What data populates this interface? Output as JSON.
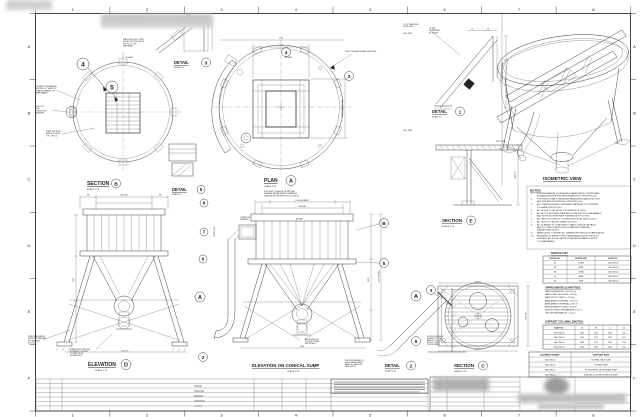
{
  "drawing": {
    "grid": {
      "cols": [
        "1",
        "2",
        "3",
        "4",
        "5",
        "6",
        "7",
        "8"
      ],
      "rows": [
        "A",
        "B",
        "C",
        "D",
        "E",
        "F"
      ]
    },
    "labels": [
      {
        "n": "section-b-title",
        "t": "SECTION",
        "x": 87,
        "y": 185,
        "fs": 5,
        "b": 1,
        "u": 1
      },
      {
        "n": "section-b-scale",
        "t": "SCALE 1:20",
        "x": 87,
        "y": 190,
        "fs": 2.2
      },
      {
        "n": "detail-5-title",
        "t": "DETAIL",
        "x": 172,
        "y": 191,
        "fs": 4.2,
        "b": 1,
        "u": 1
      },
      {
        "n": "detail-5-scale",
        "t": "SCALE 1:5",
        "x": 172,
        "y": 195,
        "fs": 2
      },
      {
        "n": "plan-title",
        "t": "PLAN",
        "x": 264,
        "y": 182,
        "fs": 5,
        "b": 1,
        "u": 1
      },
      {
        "n": "plan-scale",
        "t": "SCALE 1:20",
        "x": 264,
        "y": 187,
        "fs": 2.2
      },
      {
        "n": "detail-3-title",
        "t": "DETAIL",
        "x": 174,
        "y": 64,
        "fs": 4.2,
        "b": 1,
        "u": 1
      },
      {
        "n": "detail-3-scale",
        "t": "SCALE 1:5",
        "x": 174,
        "y": 68,
        "fs": 2
      },
      {
        "n": "detail-1-title",
        "t": "DETAIL",
        "x": 432,
        "y": 113,
        "fs": 4.2,
        "b": 1,
        "u": 1
      },
      {
        "n": "detail-1-scale",
        "t": "SCALE 1:5",
        "x": 432,
        "y": 117.5,
        "fs": 2
      },
      {
        "n": "section-e-title",
        "t": "SECTION",
        "x": 442,
        "y": 222,
        "fs": 4.5,
        "b": 1,
        "u": 1
      },
      {
        "n": "section-e-scale",
        "t": "SCALE 1:10",
        "x": 442,
        "y": 227,
        "fs": 2.2
      },
      {
        "n": "isometric-title",
        "t": "ISOMETRIC VIEW",
        "x": 543,
        "y": 180,
        "fs": 4.6,
        "b": 1,
        "u": 1
      },
      {
        "n": "elevation-d-title",
        "t": "ELEVATION",
        "x": 88,
        "y": 366,
        "fs": 5,
        "b": 1,
        "u": 1
      },
      {
        "n": "elevation-d-scale",
        "t": "SCALE 1:20",
        "x": 95,
        "y": 371,
        "fs": 2.2
      },
      {
        "n": "elevation-conical-title",
        "t": "ELEVATION ON CONICAL SUMP",
        "x": 252,
        "y": 367,
        "fs": 4.4,
        "b": 1,
        "u": 1
      },
      {
        "n": "elevation-conical-scale",
        "t": "SCALE 1:20",
        "x": 287,
        "y": 372,
        "fs": 2.2
      },
      {
        "n": "detail-2-title",
        "t": "DETAIL",
        "x": 385,
        "y": 367,
        "fs": 4.2,
        "b": 1,
        "u": 1
      },
      {
        "n": "detail-2-scale",
        "t": "SCALE 1:10",
        "x": 385,
        "y": 371.5,
        "fs": 2
      },
      {
        "n": "section-c-title",
        "t": "SECTION",
        "x": 454,
        "y": 367,
        "fs": 4.5,
        "b": 1,
        "u": 1
      },
      {
        "n": "section-c-scale",
        "t": "SCALE 1:20",
        "x": 454,
        "y": 372,
        "fs": 2.2
      },
      {
        "n": "notes-title",
        "t": "NOTES:",
        "x": 530,
        "y": 191.5,
        "fs": 3,
        "b": 1,
        "u": 1
      },
      {
        "n": "nozzle-list-title",
        "t": "NOZZLE LIST:",
        "x": 551,
        "y": 254,
        "fs": 2.6,
        "b": 1,
        "u": 1
      },
      {
        "n": "quantities-title",
        "t": "APPROXIMATE QUANTITIES:",
        "x": 545,
        "y": 288.5,
        "fs": 2.6,
        "b": 1,
        "u": 1
      },
      {
        "n": "support-lengths-title",
        "t": "SUPPORT COLUMN LENGTHS:",
        "x": 545,
        "y": 322.5,
        "fs": 2.6,
        "b": 1,
        "u": 1
      },
      {
        "n": "dim-plan-outer",
        "t": "1700",
        "x": 281,
        "y": 38.5,
        "fs": 1.8,
        "a": "middle"
      },
      {
        "n": "dim-plan-inner",
        "t": "1100",
        "x": 281,
        "y": 46,
        "fs": 1.8,
        "a": "middle"
      },
      {
        "n": "dim-elev-left-1",
        "t": "430",
        "x": 88,
        "y": 195.5,
        "fs": 1.8,
        "a": "middle"
      },
      {
        "n": "dim-elev-left-2",
        "t": "1340 DIA.",
        "x": 124,
        "y": 195.5,
        "fs": 1.8,
        "a": "middle"
      },
      {
        "n": "dim-elev-left-3",
        "t": "430",
        "x": 160,
        "y": 195.5,
        "fs": 1.8,
        "a": "middle"
      },
      {
        "n": "dim-conical-1",
        "t": "1300 (SQUARE)",
        "x": 302,
        "y": 201,
        "fs": 1.8,
        "a": "middle"
      },
      {
        "n": "dim-conical-2",
        "t": "1140 DIA.",
        "x": 302,
        "y": 207,
        "fs": 1.8,
        "a": "middle"
      },
      {
        "n": "dim-detail1-1",
        "t": "94",
        "x": 472,
        "y": 29.5,
        "fs": 1.8,
        "a": "middle"
      },
      {
        "n": "dim-detail1-2",
        "t": "36",
        "x": 488,
        "y": 29.5,
        "fs": 1.8,
        "a": "middle"
      },
      {
        "n": "dim-conical-base",
        "t": "1460",
        "x": 302,
        "y": 347,
        "fs": 1.8,
        "a": "middle"
      },
      {
        "n": "dim-elev-base",
        "t": "940 TYP.",
        "x": 125,
        "y": 351.5,
        "fs": 1.8,
        "a": "middle"
      },
      {
        "n": "dim-sectionc-base",
        "t": "960 TYP.",
        "x": 478,
        "y": 350,
        "fs": 1.8,
        "a": "middle"
      },
      {
        "n": "dim-sectionc-top",
        "t": "1300 SQ.",
        "x": 478,
        "y": 282.5,
        "fs": 1.8,
        "a": "middle"
      },
      {
        "n": "dim-plan-right",
        "t": "1100 (GRATING DIA.)",
        "x": 343,
        "y": 108,
        "fs": 1.8,
        "a": "middle",
        "r": -90
      },
      {
        "n": "dim-detail1-face",
        "t": "ORDER CUTTING FACE",
        "x": 503,
        "y": 72,
        "fs": 1.6,
        "a": "middle",
        "r": -90
      },
      {
        "n": "dim-elev-height",
        "t": "1600",
        "x": 74,
        "y": 280,
        "fs": 1.8,
        "a": "middle",
        "r": -90
      },
      {
        "n": "dim-conical-height1",
        "t": "1630",
        "x": 369,
        "y": 280,
        "fs": 1.8,
        "a": "middle",
        "r": -90
      },
      {
        "n": "dim-conical-height2",
        "t": "2150 OVERALL",
        "x": 379.5,
        "y": 276,
        "fs": 1.8,
        "a": "middle",
        "r": -90
      },
      {
        "n": "dim-sectione",
        "t": "1200 TYP.",
        "x": 516,
        "y": 175,
        "fs": 1.8,
        "a": "middle",
        "r": -90
      },
      {
        "n": "dim-sectionc-side",
        "t": "1300 SQ.",
        "x": 526.5,
        "y": 316,
        "fs": 1.8,
        "a": "middle",
        "r": -90
      },
      {
        "n": "cl-sump-1",
        "t": "℄ SUMP",
        "x": 126,
        "y": 58,
        "fs": 1.8
      },
      {
        "n": "cl-sump-2",
        "t": "℄ SUMP",
        "x": 285,
        "y": 58,
        "fs": 1.8
      },
      {
        "n": "cl-sump-3",
        "t": "℄ SUMP",
        "x": 296,
        "y": 219.5,
        "fs": 1.8
      }
    ],
    "annotations": [
      {
        "n": "note-slotted-holes-1",
        "x": 123,
        "y": 17,
        "lines": [
          "DIA 20 HOLE SLOTTED",
          "HOLES F/W M20 GR 8.8",
          "BOLTS 14, TYP.",
          "BEHIND"
        ]
      },
      {
        "n": "note-slotted-holes-2",
        "x": 123,
        "y": 40,
        "lines": [
          "DIA 20 HOLE SLOTTED",
          "HOLES F/W M20 GR 8.8",
          "BOLTS 14, TYP.",
          "(FAR SIDE)"
        ]
      },
      {
        "n": "note-grating-panel",
        "x": 36,
        "y": 87,
        "lines": [
          "CONNECT PER ANGLE",
          "BOLTED PLT SHIM LOC",
          "GRATING PANEL TYP.",
          "REMOVABLE"
        ]
      },
      {
        "n": "note-launder",
        "x": 35,
        "y": 107,
        "lines": [
          "150 UC 23",
          "PIPE",
          "CONDUIT 50",
          "LAUNDER"
        ]
      },
      {
        "n": "note-sump-support",
        "x": 46,
        "y": 132,
        "lines": [
          "SUMP SUPPORT",
          "ANGLE 50x50x6",
          "TYP. 4 PLCS"
        ]
      },
      {
        "n": "note-stillage",
        "x": 345,
        "y": 52,
        "lines": [
          "FOR STILLAGE DETAILS SEE DWG"
        ]
      },
      {
        "n": "note-backing-strip",
        "x": 403,
        "y": 25,
        "lh": 2.2,
        "lines": [
          "2.5 PLT BACKING",
          "STRIP 40 W"
        ]
      },
      {
        "n": "note-full-pen-1",
        "x": 403,
        "y": 34,
        "lines": [
          "FULL PEN."
        ]
      },
      {
        "n": "note-full-pen-2",
        "x": 403,
        "y": 131,
        "lines": [
          "FULL PEN."
        ]
      },
      {
        "n": "note-full-pen-3",
        "x": 496,
        "y": 142,
        "lines": [
          "FULL PEN."
        ]
      },
      {
        "n": "note-stiffener",
        "x": 429,
        "y": 29,
        "lines": [
          "10 THK",
          "STIFFENER",
          "PL 8 (TYP)"
        ]
      },
      {
        "n": "note-detail3-dim",
        "x": 186,
        "y": 16,
        "fs": 1.8,
        "lines": [
          "36  36"
        ]
      },
      {
        "n": "note-drain-valve",
        "x": 28,
        "y": 337,
        "lines": [
          "DRN DRAIN VALVE",
          "SUPPORT BRACKET",
          "PLT WELDED",
          "4 PLCS"
        ]
      },
      {
        "n": "note-drain-nozzle",
        "x": 70,
        "y": 350,
        "fs": 1.7,
        "lh": 2,
        "lines": [
          "DRAIN NOZZLE N2 DN80",
          "BOSSED PLT ON PIPE",
          "TO 50NB 2 PLCS",
          "ALL AROUND 6"
        ]
      },
      {
        "n": "note-bkg-nozzle",
        "x": 305,
        "y": 340,
        "fs": 1.7,
        "lh": 2,
        "lines": [
          "BKG NOZZLE N4",
          "SUPPORT DETAIL",
          "SEE DETAIL 3"
        ]
      },
      {
        "n": "note-drn-pipe-assy",
        "x": 345,
        "y": 361,
        "fs": 1.7,
        "lh": 2,
        "lines": [
          "DRN PIPE SUB ASSY TO",
          "SUIT FLANGE ORIENT.",
          "PANEL & OVERFLOW",
          "PADS 4 PLCS"
        ]
      },
      {
        "n": "note-gusset",
        "x": 427,
        "y": 337,
        "fs": 1.7,
        "lh": 2,
        "lines": [
          "RUCKUS NOZZLE N3",
          "GUSSET PLT 8 THK",
          "BASE PLT 12 THK",
          "M20 H.D. BOLTS",
          "25 NOM. GROUT"
        ]
      },
      {
        "n": "note-overflow-launder",
        "x": 240,
        "y": 218,
        "fs": 1.8,
        "lh": 2,
        "lines": [
          "OVERFLOW",
          "LAUNDER"
        ]
      },
      {
        "n": "note-overflow",
        "x": 215,
        "y": 237,
        "fs": 1.8,
        "r": -90,
        "lines": [
          "OVERFLOW"
        ]
      },
      {
        "n": "note-plan-location",
        "x": 264,
        "y": 192,
        "fs": 1.8,
        "lh": 2.2,
        "lines": [
          "FOR SUMP LOCATION ON SITE SEE",
          "GENERAL ARRANGEMENT DRAWINGS.",
          "ORIENTATION SHOWN FOR 1300-TNK-05."
        ]
      }
    ],
    "bubbles": [
      {
        "x": 116,
        "y": 183.5,
        "r": 4.5,
        "t": "B"
      },
      {
        "x": 201,
        "y": 189.5,
        "r": 4,
        "t": "5"
      },
      {
        "x": 291,
        "y": 180.5,
        "r": 5,
        "t": "A"
      },
      {
        "x": 206,
        "y": 62.5,
        "r": 4.5,
        "t": "3"
      },
      {
        "x": 460,
        "y": 111.5,
        "r": 4.5,
        "t": "1"
      },
      {
        "x": 471,
        "y": 220.5,
        "r": 4.5,
        "t": "E"
      },
      {
        "x": 126,
        "y": 364.5,
        "r": 5,
        "t": "D"
      },
      {
        "x": 411,
        "y": 365.5,
        "r": 4.5,
        "t": "2"
      },
      {
        "x": 483,
        "y": 365.5,
        "r": 4.5,
        "t": "C"
      },
      {
        "x": 83,
        "y": 64,
        "r": 6,
        "t": "4"
      },
      {
        "x": 112,
        "y": 87,
        "r": 6,
        "t": "5"
      },
      {
        "x": 349,
        "y": 76,
        "r": 4.5,
        "t": "3"
      },
      {
        "x": 286,
        "y": 52,
        "r": 4.5,
        "t": "4"
      },
      {
        "x": 204,
        "y": 203,
        "r": 4,
        "t": "6"
      },
      {
        "x": 204,
        "y": 232,
        "r": 4,
        "t": "7"
      },
      {
        "x": 203,
        "y": 259,
        "r": 4,
        "t": "8"
      },
      {
        "x": 200,
        "y": 297,
        "r": 5,
        "t": "A"
      },
      {
        "x": 203,
        "y": 357,
        "r": 4.5,
        "t": "2"
      },
      {
        "x": 384,
        "y": 223,
        "r": 4.5,
        "t": "B"
      },
      {
        "x": 384,
        "y": 263,
        "r": 4.5,
        "t": "5"
      },
      {
        "x": 416,
        "y": 296,
        "r": 5,
        "t": "A"
      },
      {
        "x": 416,
        "y": 341,
        "r": 4.5,
        "t": "6"
      },
      {
        "x": 431,
        "y": 290,
        "r": 4.5,
        "t": "3"
      }
    ],
    "notes": {
      "items": [
        [
          "FOR MECHANICAL (PLATEWORK) FABRICATION, TESTING AND",
          "INSTALLATION SEE PPM SPECIFICATION No. PPM-SPEC-001."
        ],
        [
          "FOR STRUCTURAL STEELWORK FABRICATION AND ERECTION",
          "SEE PPM SPECIFICATION No. PPM-SPEC-002."
        ],
        [
          "ALL STEELWORK AND PLATEWORK MATERIAL TO CONFORM",
          "TO GRADE S355JR U.N.O."
        ],
        [
          "ALL HOLES TO BE 18 DIA. FOR M16 BOLTS U.N.O."
        ],
        [
          "ALL BOLTS, NUTS AND WASHERS TO BE ELECTRO-GALVANISED",
          "AND SUPPLIED WITH FREE TURNING NUTS TO SUIT."
        ],
        [
          "ALL WELDS TO BE 6mm CONTINUOUS FILLET WELDS U.N.O."
        ],
        [
          "ALL BOLTS TO BE M16 GRADE 8.8 U.N.O."
        ],
        [
          "ALL FLANGES TO CONFORM TO TABLE 1000/3 (FLAT FACE)",
          "AND TO COME COMPLETE WITH BACKING FLANGES,",
          "GASKETS AND BOLTS."
        ],
        [
          "FABRICATOR TO VERIFY ALL DIMENSIONS PRIOR TO FABRICATION."
        ],
        [
          "ENGINEER TO INSPECT FULLY ASSEMBLED EQUIP. PRIOR TO",
          "DELIVERY. ALL EQUIP. PARTS TO BE MATCH MARKED PRIOR",
          "TO DISASSEMBLY."
        ]
      ]
    },
    "quantities": {
      "lines": [
        "MASS PLATEWORK = 2052.59 kg",
        "MASS STEEL SECTIONS = 785 kg",
        "MASS BOLTS & NUTS = 22.4 kg",
        "AREA (PAINT) INTERNAL = 8.05 m²",
        "AREA (PAINT) EXTERNAL = 9.39 m²",
        "AREA (RUBBER LINING) = 8.05 m²",
        "LENGTH STEEL PIPE BARRIER = 3.2 m",
        "LENGTH HANDRAILING = 12.6 m"
      ]
    },
    "tables": {
      "nozzle_list": {
        "header": [
          "NOZZLE NO.",
          "NOZZLE SIZE",
          "EQUIP. NO."
        ],
        "rows": [
          [
            "N1",
            "100NB",
            "1300-TNK-05"
          ],
          [
            "N2",
            "80NB",
            "1300-TNK-05"
          ],
          [
            "N3",
            "100NB",
            "1300-TNK-10"
          ],
          [
            "N4",
            "80NB",
            "1300-TNK-19"
          ],
          [
            "N5",
            "50NB",
            "1300-TNK-20"
          ]
        ]
      },
      "support_lengths": {
        "header": [
          "EQUIP. NO.",
          "A",
          "B",
          "C",
          "D"
        ],
        "rows": [
          [
            "1300-TNK-05",
            "1365",
            "1615",
            "2041",
            "410"
          ],
          [
            "1300-TNK-10",
            "1365",
            "1615",
            "2041",
            "410"
          ],
          [
            "1300-TNK-19",
            "1485",
            "1735",
            "2161",
            "530"
          ],
          [
            "1300-TNK-20",
            "1365",
            "1615",
            "2041",
            "410"
          ]
        ]
      },
      "equipment": {
        "header": [
          "EQUIPMENT NUMBER",
          "EQUIPMENT NAME"
        ],
        "rows": [
          [
            "1300-TNK-05",
            "RC FINAL TAILS SUMP"
          ],
          [
            "1300-TNK-10",
            "RC FEED SUMP"
          ],
          [
            "1300-TNK-19",
            "RC ROUGHER CONCENTRATE SUMP"
          ],
          [
            "1300-TNK-20",
            "STACKER CYCLONE OVERFLOW SUMP"
          ]
        ]
      }
    }
  }
}
